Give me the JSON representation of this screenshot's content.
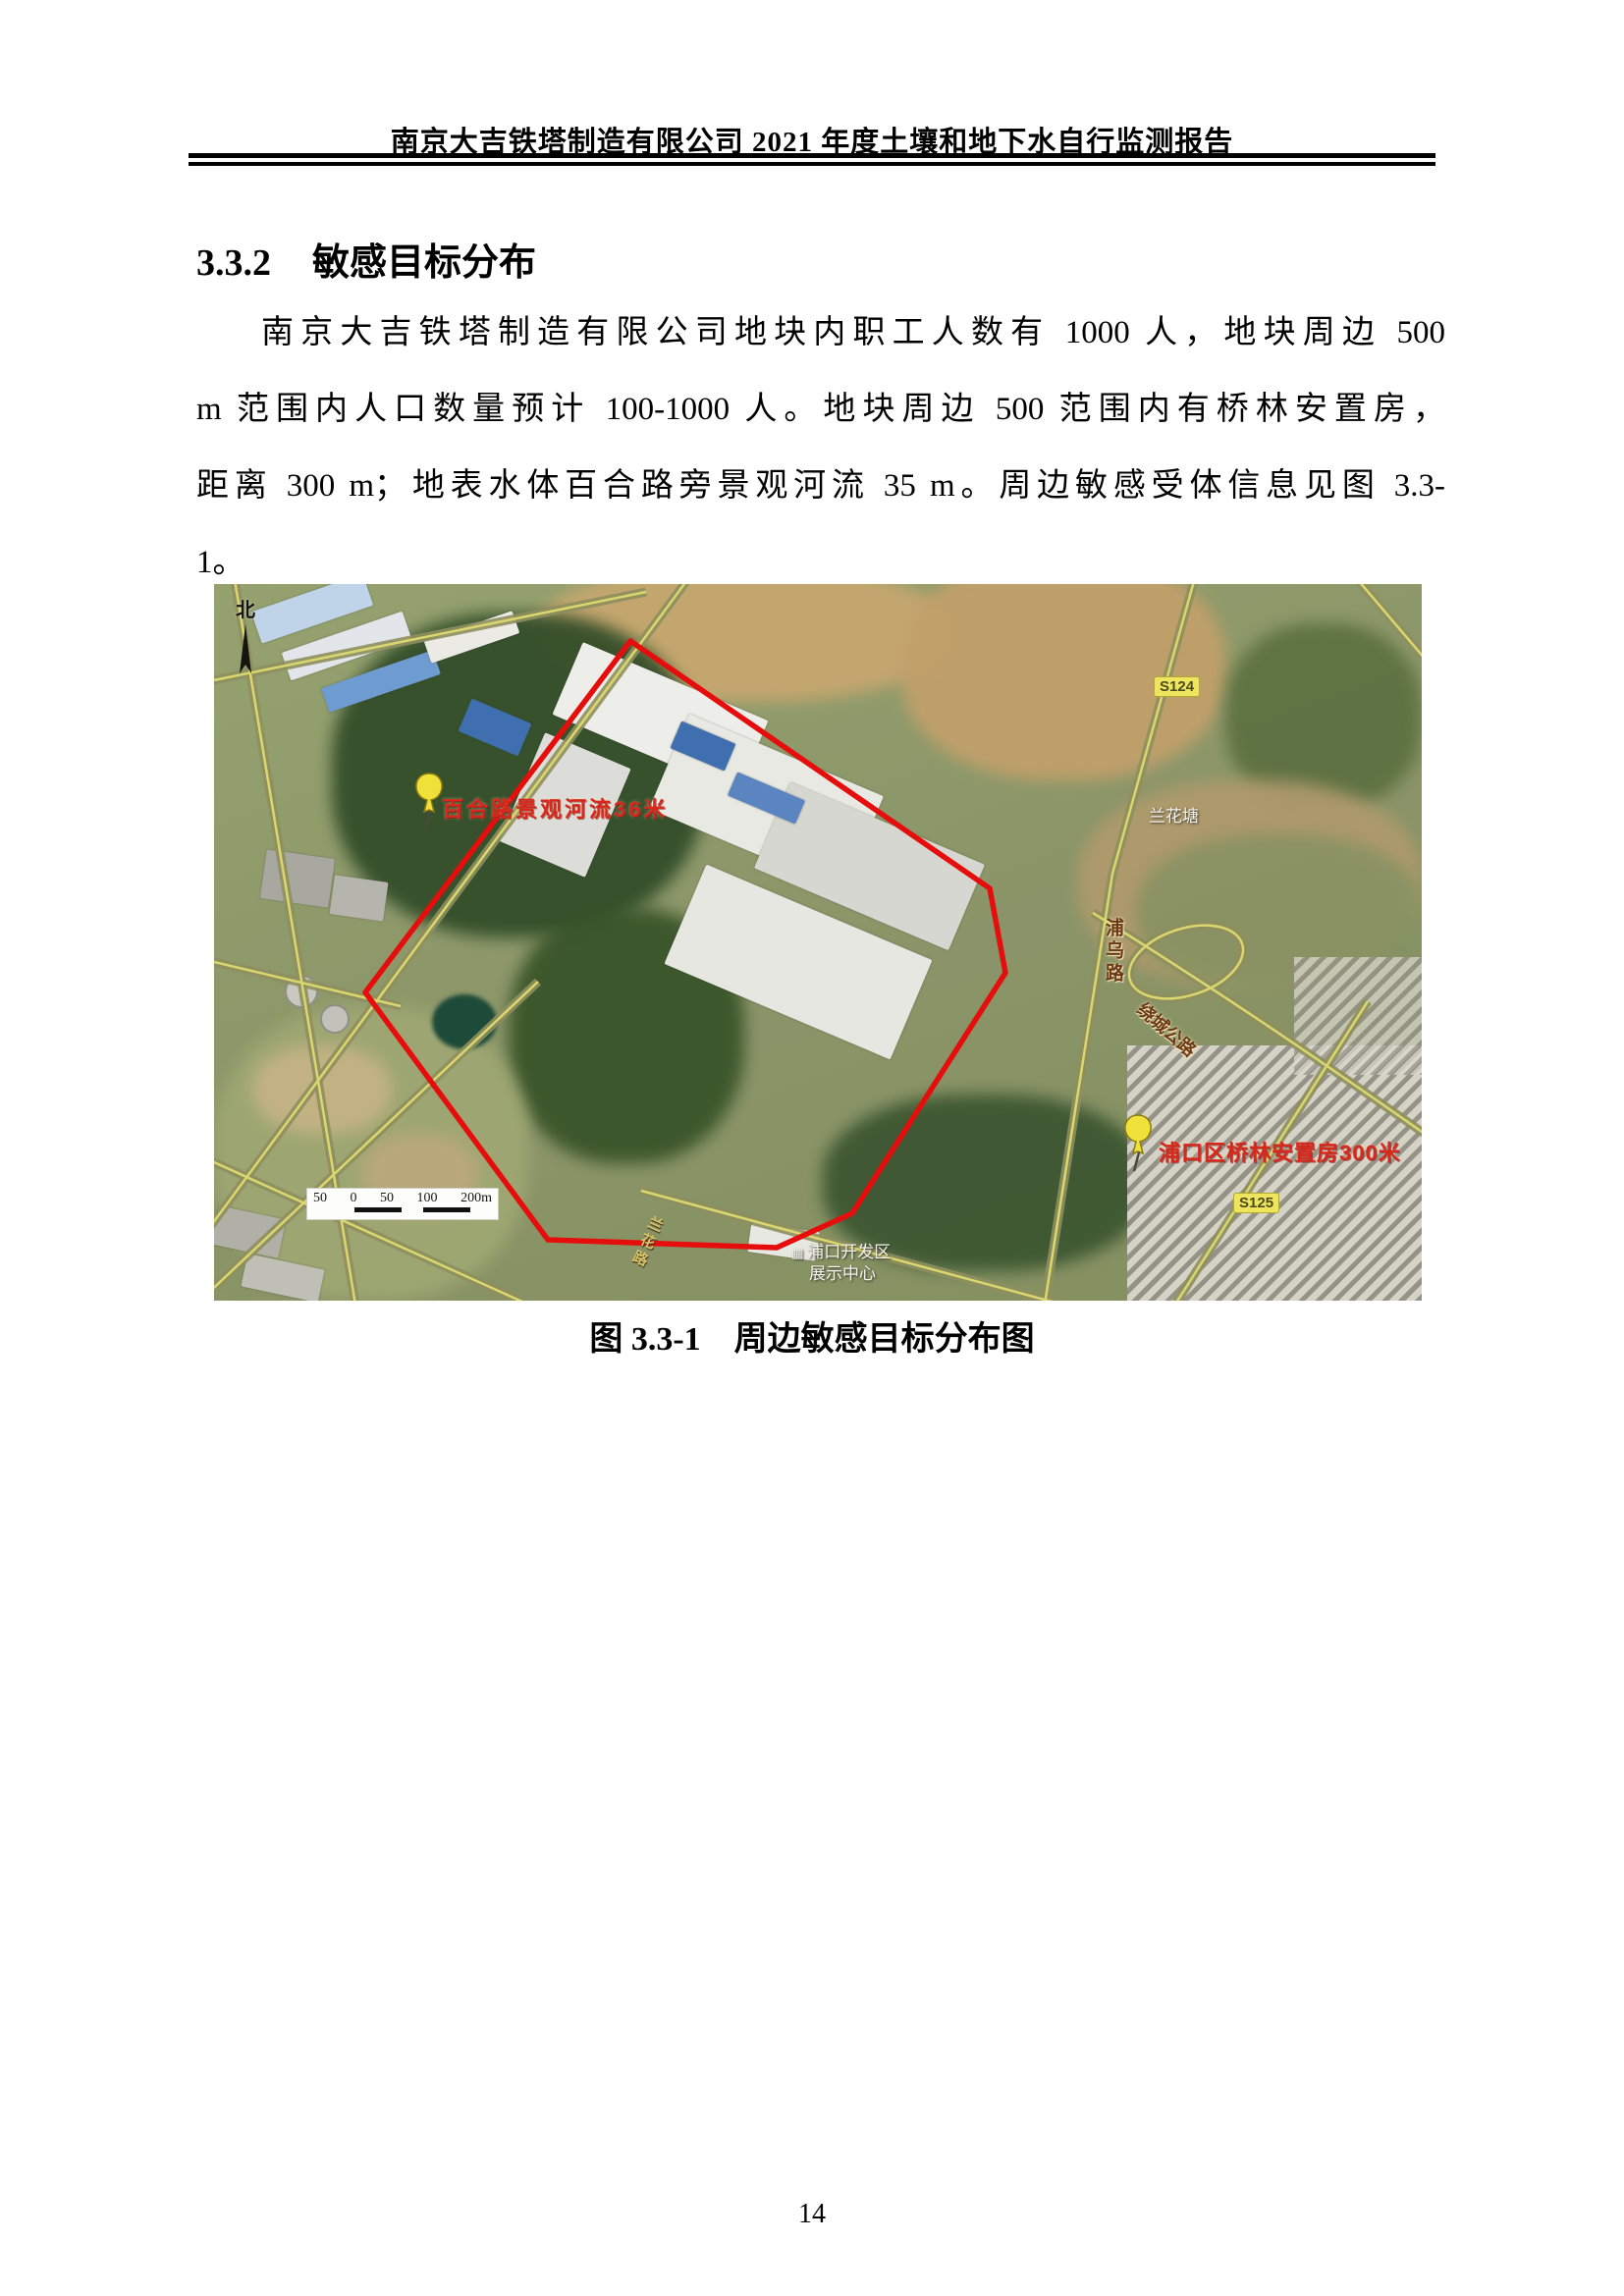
{
  "document": {
    "header_title": "南京大吉铁塔制造有限公司 2021 年度土壤和地下水自行监测报告",
    "section_number": "3.3.2",
    "section_title": "敏感目标分布",
    "paragraph_lines": [
      "南京大吉铁塔制造有限公司地块内职工人数有 1000 人，地块周边 500",
      "m 范围内人口数量预计 100-1000 人。地块周边 500 范围内有桥林安置房，",
      "距离 300 m；地表水体百合路旁景观河流 35 m。周边敏感受体信息见图 3.3-",
      "1。"
    ],
    "figure_caption_label": "图 3.3-1",
    "figure_caption_text": "周边敏感目标分布图",
    "page_number": "14"
  },
  "map": {
    "north_label": "北",
    "pins": [
      {
        "label": "百合路景观河流36米"
      },
      {
        "label": "浦口区桥林安置房300米"
      }
    ],
    "badges": [
      {
        "text": "S124"
      },
      {
        "text": "S125"
      }
    ],
    "roads": [
      {
        "name": "浦乌路"
      },
      {
        "name": "绕城公路"
      },
      {
        "name": "兰花路"
      }
    ],
    "places": [
      {
        "name": "兰花塘"
      },
      {
        "name": "浦口开发区"
      },
      {
        "name": "展示中心"
      }
    ],
    "scale_ticks": [
      "50",
      "0",
      "50",
      "100",
      "200m"
    ],
    "colors": {
      "boundary": "#e60d0d",
      "pin_head": "#f0e03a",
      "pin_text": "#d8281c"
    }
  }
}
